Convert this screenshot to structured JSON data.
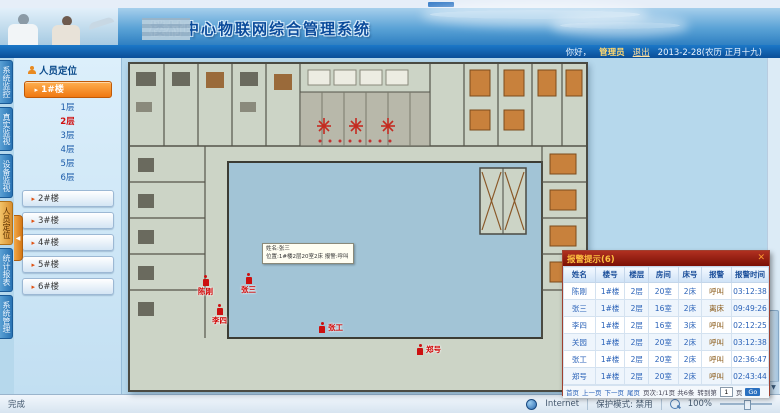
{
  "browser": {
    "status_done": "完成",
    "zone_label": "Internet",
    "protected_mode": "保护模式: 禁用",
    "zoom_level": "100%"
  },
  "header": {
    "title": "楼村中心物联网综合管理系统",
    "greeting": "你好，",
    "username": "管理员",
    "logout": "退出",
    "date": "2013-2-28(农历 正月十九)"
  },
  "nav_tabs": [
    {
      "label": "系统监控",
      "active": false
    },
    {
      "label": "真实监视",
      "active": false
    },
    {
      "label": "设备监视",
      "active": false
    },
    {
      "label": "人员定位",
      "active": true
    },
    {
      "label": "统计报表",
      "active": false
    },
    {
      "label": "系统管理",
      "active": false
    }
  ],
  "sidebar": {
    "title": "人员定位",
    "expanded_building": "1#楼",
    "collapse_icon": "◀",
    "floors": [
      {
        "label": "1层",
        "active": false
      },
      {
        "label": "2层",
        "active": true
      },
      {
        "label": "3层",
        "active": false
      },
      {
        "label": "4层",
        "active": false
      },
      {
        "label": "5层",
        "active": false
      },
      {
        "label": "6层",
        "active": false
      }
    ],
    "buildings": [
      "2#楼",
      "3#楼",
      "4#楼",
      "5#楼",
      "6#楼"
    ]
  },
  "map": {
    "tooltip": {
      "line1": "姓名:张三",
      "line2": "位置:1#楼2层20室2床 报警:呼叫"
    },
    "markers": [
      {
        "name": "陈刚",
        "x": 198,
        "y": 275,
        "side": "b"
      },
      {
        "name": "张三",
        "x": 241,
        "y": 273,
        "side": "b"
      },
      {
        "name": "李四",
        "x": 212,
        "y": 304,
        "side": "b"
      },
      {
        "name": "张工",
        "x": 318,
        "y": 322,
        "side": "r"
      },
      {
        "name": "郑号",
        "x": 416,
        "y": 344,
        "side": "r"
      }
    ]
  },
  "alarm_panel": {
    "title": "报警提示(6)",
    "close_icon": "✕",
    "columns": [
      "姓名",
      "楼号",
      "楼层",
      "房间",
      "床号",
      "报警",
      "报警时间"
    ],
    "rows": [
      [
        "陈刚",
        "1#楼",
        "2层",
        "20室",
        "2床",
        "呼叫",
        "03:12:38"
      ],
      [
        "张三",
        "1#楼",
        "2层",
        "16室",
        "2床",
        "离床",
        "09:49:26"
      ],
      [
        "李四",
        "1#楼",
        "2层",
        "16室",
        "3床",
        "呼叫",
        "02:12:25"
      ],
      [
        "关园",
        "1#楼",
        "2层",
        "20室",
        "2床",
        "呼叫",
        "03:12:38"
      ],
      [
        "张工",
        "1#楼",
        "2层",
        "20室",
        "2床",
        "呼叫",
        "02:36:47"
      ],
      [
        "郑号",
        "1#楼",
        "2层",
        "20室",
        "2床",
        "呼叫",
        "02:43:44"
      ]
    ],
    "pager": {
      "first": "首页",
      "prev": "上一页",
      "next": "下一页",
      "last": "尾页",
      "info": "页次:1/1页 共6条",
      "goto_label": "转到第",
      "page_value": "1",
      "page_unit": "页",
      "go": "Go"
    }
  }
}
